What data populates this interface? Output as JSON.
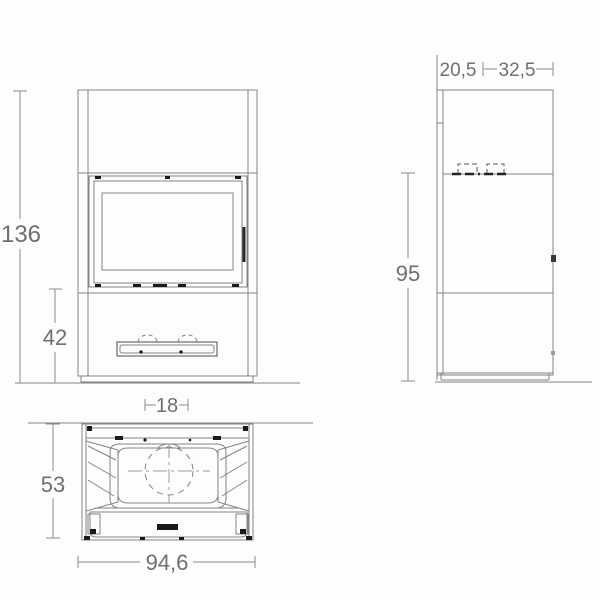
{
  "drawing": {
    "type": "stove-technical-drawing",
    "background_color": "#fdfdfd",
    "line_color": "#848484",
    "dark_mark_color": "#1a1a1a",
    "text_color": "#6f6f6f"
  },
  "views": {
    "front": {
      "name": "front elevation",
      "dims": {
        "total_height": "136",
        "base_height": "42"
      }
    },
    "side": {
      "name": "side elevation",
      "dims": {
        "depth_back": "20,5",
        "depth_front": "32,5",
        "body_height": "95"
      }
    },
    "plan": {
      "name": "plan view",
      "dims": {
        "flue_width": "18",
        "depth": "53",
        "width": "94,6"
      }
    }
  }
}
